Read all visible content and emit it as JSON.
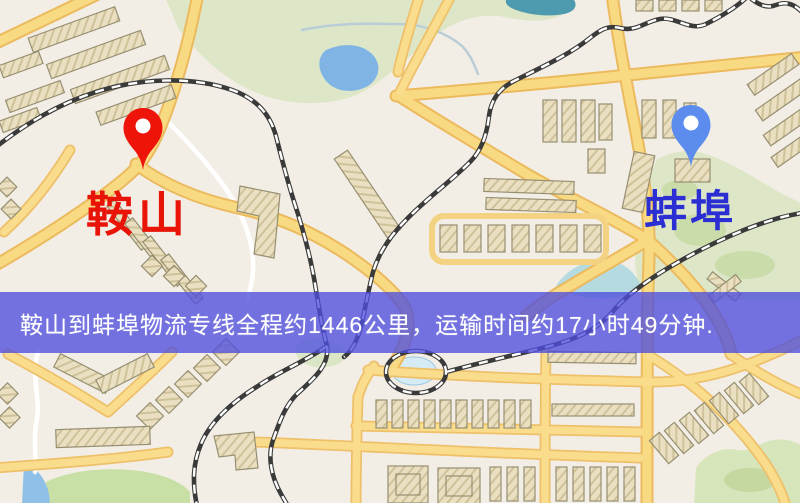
{
  "map": {
    "origin": {
      "label": "鞍山",
      "marker": "red-map-pin"
    },
    "destination": {
      "label": "蚌埠",
      "marker": "blue-map-pin"
    }
  },
  "banner": {
    "text": "鞍山到蚌埠物流专线全程约1446公里，运输时间约17小时49分钟."
  },
  "route_summary": {
    "origin": "鞍山",
    "destination": "蚌埠",
    "distance_km": "1446",
    "duration_hours": "17",
    "duration_minutes": "49"
  },
  "colors": {
    "pin_red": "#ee1409",
    "pin_blue": "#5b8cee",
    "origin_label": "#e91408",
    "destination_label": "#2b2ed2",
    "banner_bg": "rgba(78,78,222,0.78)",
    "road_yellow": "#f8da82",
    "map_bg": "#f3eee5",
    "park_green": "#dde7c8",
    "water_blue": "#7fb4e4"
  }
}
